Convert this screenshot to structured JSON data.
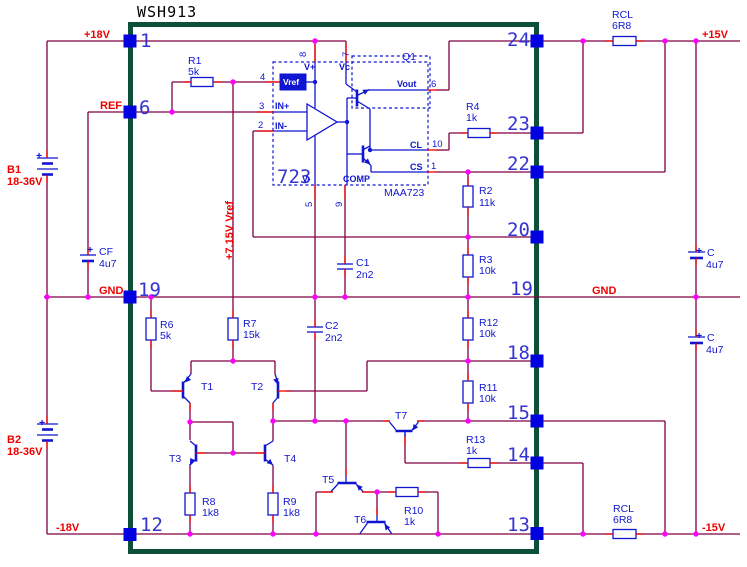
{
  "colors": {
    "wire": "#800040",
    "terminal": "#ee0000",
    "symbol": "#1016d0",
    "border": "#0d5038",
    "junction": "#ff00ff",
    "pin_square": "#0000e0",
    "net_label": "#ee0000",
    "background": "#ffffff"
  },
  "title": "WSH913",
  "pins": {
    "left": [
      "1",
      "6",
      "19",
      "12"
    ],
    "right": [
      "24",
      "23",
      "22",
      "20",
      "19",
      "18",
      "15",
      "14",
      "13"
    ]
  },
  "nets": {
    "vpos": "+18V",
    "ref": "REF",
    "gnd_left": "GND",
    "gnd_right": "GND",
    "vneg": "-18V",
    "out_pos": "+15V",
    "out_neg": "-15V",
    "vref_rail": "+7.15V Vref"
  },
  "batteries": {
    "b1": {
      "ref": "B1",
      "value": "18-36V",
      "polarity": "+"
    },
    "b2": {
      "ref": "B2",
      "value": "18-36V",
      "polarity": "+"
    }
  },
  "resistors": {
    "r1": {
      "ref": "R1",
      "value": "5k"
    },
    "r2": {
      "ref": "R2",
      "value": "11k"
    },
    "r3": {
      "ref": "R3",
      "value": "10k"
    },
    "r4": {
      "ref": "R4",
      "value": "1k"
    },
    "r6": {
      "ref": "R6",
      "value": "5k"
    },
    "r7": {
      "ref": "R7",
      "value": "15k"
    },
    "r8": {
      "ref": "R8",
      "value": "1k8"
    },
    "r9": {
      "ref": "R9",
      "value": "1k8"
    },
    "r10": {
      "ref": "R10",
      "value": "1k"
    },
    "r11": {
      "ref": "R11",
      "value": "10k"
    },
    "r12": {
      "ref": "R12",
      "value": "10k"
    },
    "r13": {
      "ref": "R13",
      "value": "1k"
    },
    "rcl_top": {
      "ref": "RCL",
      "value": "6R8"
    },
    "rcl_bottom": {
      "ref": "RCL",
      "value": "6R8"
    }
  },
  "capacitors": {
    "cf": {
      "ref": "CF",
      "value": "4u7",
      "polarity": "+"
    },
    "c1": {
      "ref": "C1",
      "value": "2n2"
    },
    "c2": {
      "ref": "C2",
      "value": "2n2"
    },
    "c_top": {
      "ref": "C",
      "value": "4u7",
      "polarity": "+"
    },
    "c_bottom": {
      "ref": "C",
      "value": "4u7",
      "polarity": "+"
    }
  },
  "transistors": {
    "q1": "Q1",
    "t1": "T1",
    "t2": "T2",
    "t3": "T3",
    "t4": "T4",
    "t5": "T5",
    "t6": "T6",
    "t7": "T7"
  },
  "ic": {
    "big_label": "723",
    "part": "MAA723",
    "labels": {
      "vref": "Vref",
      "vplus": "V+",
      "vc": "Vc",
      "inp": "IN+",
      "inn": "IN-",
      "vout": "Vout",
      "cl": "CL",
      "cs": "CS",
      "vminus": "V-",
      "comp": "COMP"
    },
    "stubs": {
      "n8": "8",
      "n7": "7",
      "n4": "4",
      "n3": "3",
      "n2": "2",
      "n6": "6",
      "n10": "10",
      "n1": "1",
      "n5": "5",
      "n9": "9"
    }
  }
}
